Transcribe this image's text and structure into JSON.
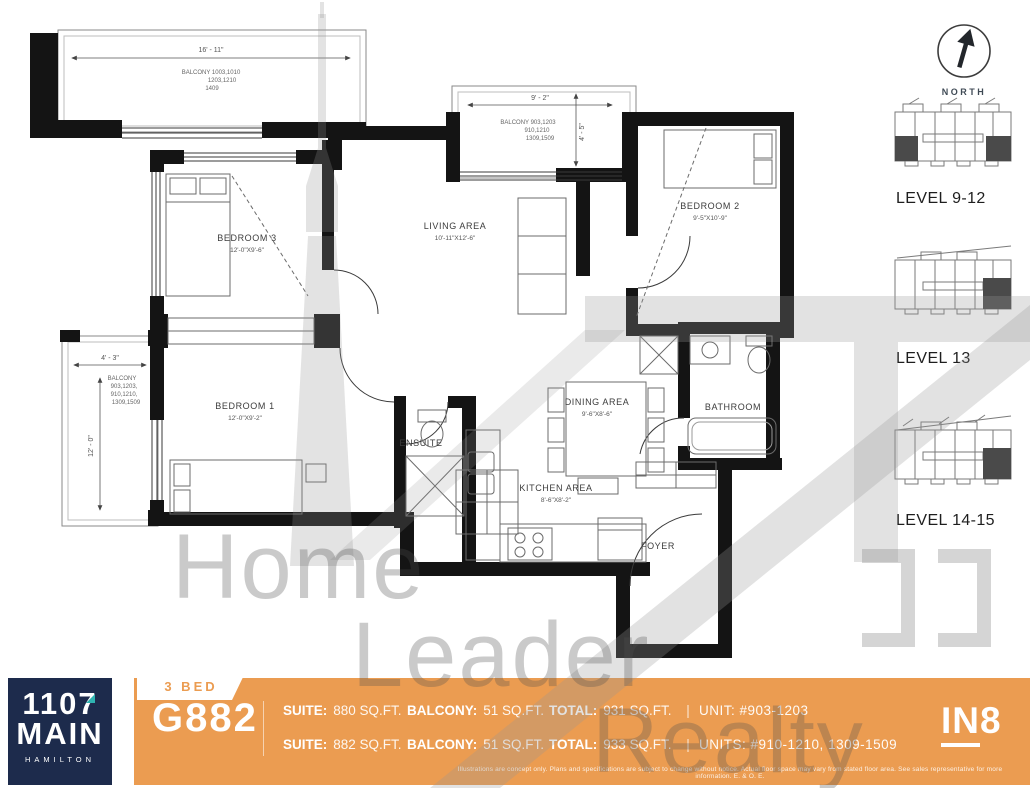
{
  "colors": {
    "orange": "#EB9C51",
    "navy": "#1D2B4C",
    "teal": "#2FB4B1"
  },
  "floor_plan": {
    "rooms": [
      {
        "label": "BEDROOM 3",
        "dims": "12'-0\"X9'-6\""
      },
      {
        "label": "LIVING AREA",
        "dims": "10'-11\"X12'-6\""
      },
      {
        "label": "BEDROOM 2",
        "dims": "9'-5\"X10'-9\""
      },
      {
        "label": "BEDROOM 1",
        "dims": "12'-0\"X9'-2\""
      },
      {
        "label": "DINING AREA",
        "dims": "9'-6\"X8'-6\""
      },
      {
        "label": "KITCHEN AREA",
        "dims": "8'-6\"X8'-2\""
      },
      {
        "label": "BATHROOM"
      },
      {
        "label": "ENSUITE"
      },
      {
        "label": "FOYER"
      }
    ],
    "balconies": [
      {
        "dim_w": "16' - 11\"",
        "lines": [
          "BALCONY 1003,1010",
          "1203,1210",
          "1409"
        ]
      },
      {
        "dim_w": "9' - 2\"",
        "dim_h": "4' - 5\"",
        "lines": [
          "BALCONY 903,1203",
          "910,1210",
          "1309,1509"
        ]
      },
      {
        "dim_w": "4' - 3\"",
        "dim_h": "12' - 0\"",
        "lines": [
          "BALCONY",
          "903,1203,",
          "910,1210,",
          "1309,1509"
        ]
      }
    ]
  },
  "compass": {
    "label": "NORTH"
  },
  "keyplans": [
    {
      "label": "LEVEL 9-12"
    },
    {
      "label": "LEVEL 13"
    },
    {
      "label": "LEVEL 14-15"
    }
  ],
  "watermark": {
    "words": [
      "Home",
      "Leader",
      "Realty"
    ]
  },
  "banner": {
    "logo": {
      "line1": "1107",
      "line2": "MAIN",
      "line3": "HAMILTON"
    },
    "bed_tab": "3 BED",
    "model": "G882",
    "rows": [
      {
        "suite_label": "SUITE:",
        "suite": "880 SQ.FT.",
        "balcony_label": "BALCONY:",
        "balcony": "51 SQ.FT.",
        "total_label": "TOTAL:",
        "total": "931 SQ.FT.",
        "pipe": "|",
        "unit": "UNIT: #903-1203"
      },
      {
        "suite_label": "SUITE:",
        "suite": "882 SQ.FT.",
        "balcony_label": "BALCONY:",
        "balcony": "51 SQ.FT.",
        "total_label": "TOTAL:",
        "total": "933 SQ.FT.",
        "pipe": "|",
        "unit": "UNITS: #910-1210, 1309-1509"
      }
    ],
    "disclaimer": "Illustrations are concept only. Plans and specifications are subject to change without notice. Actual floor space may vary from stated floor area. See sales representative for more information. E. & O. E.",
    "brand_in": "IN",
    "brand_8": "8"
  }
}
